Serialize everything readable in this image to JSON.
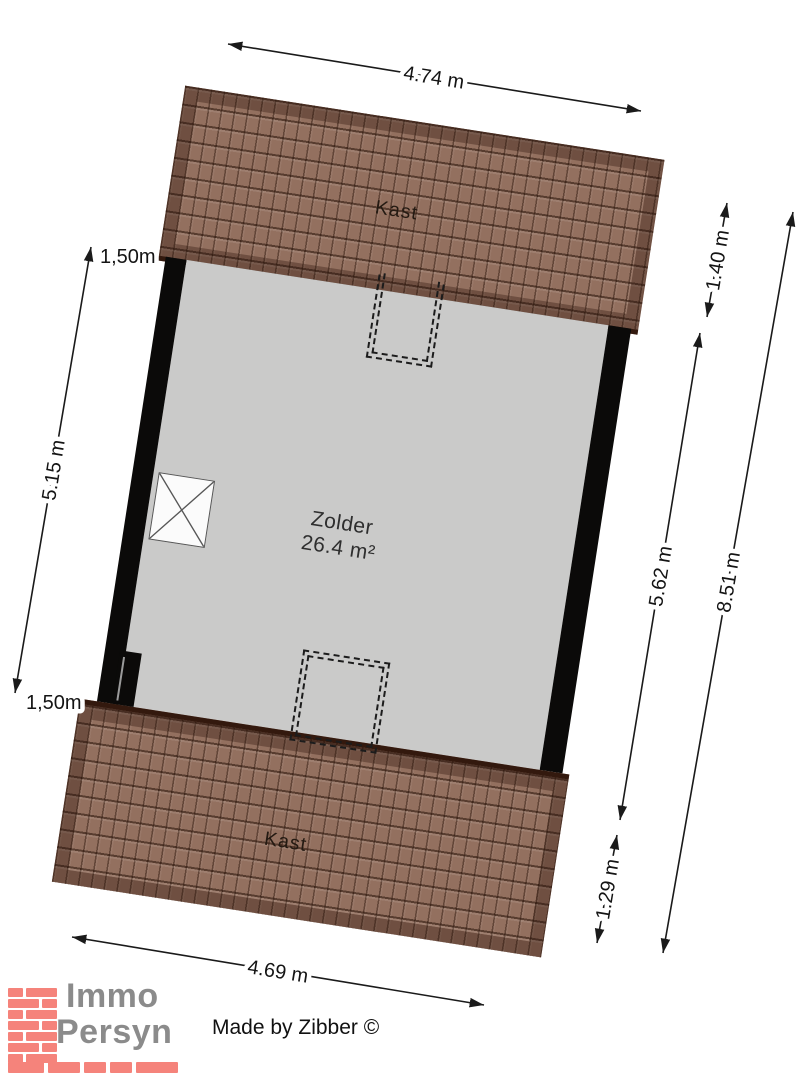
{
  "plan": {
    "room": {
      "name": "Zolder",
      "area": "26.4 m²"
    },
    "closets": {
      "top": "Kast",
      "bottom": "Kast"
    }
  },
  "dimensions": {
    "top_width": "4.74 m",
    "bottom_width": "4.69 m",
    "left": {
      "knee_wall_top": "1,50m",
      "room_length": "5.15 m",
      "knee_wall_bottom": "1,50m"
    },
    "right": {
      "roof_top": "1.40 m",
      "room_length": "5.62 m",
      "total_length": "8.51 m",
      "roof_bottom": "1.29 m"
    }
  },
  "branding": {
    "logo_line1": "Immo",
    "logo_line2": "Persyn",
    "credit": "Made by Zibber ©"
  },
  "colors": {
    "roof_brown": "#93705f",
    "roof_edge": "#33190e",
    "floor_gray": "#cacac9",
    "wall_black": "#0b0a09",
    "brick_salmon": "#f5837b",
    "logo_gray": "#8b8b8b"
  }
}
